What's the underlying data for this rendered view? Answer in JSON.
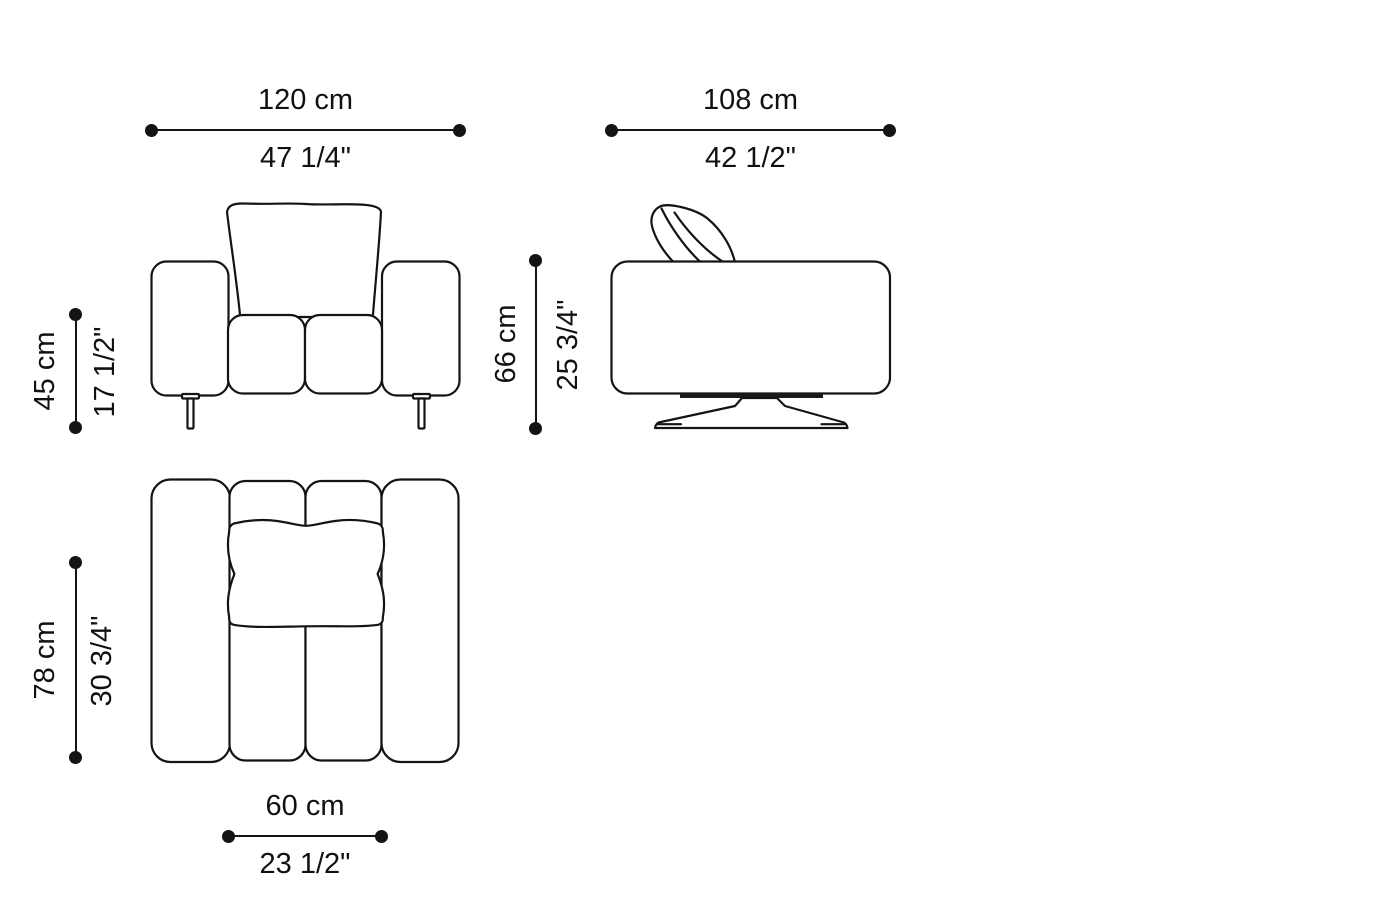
{
  "colors": {
    "background": "#ffffff",
    "line": "#141414",
    "text": "#111111"
  },
  "dims": {
    "front_width": {
      "cm": "120 cm",
      "inches": "47 1/4\""
    },
    "front_height": {
      "cm": "45 cm",
      "inches": "17 1/2\""
    },
    "side_width": {
      "cm": "108 cm",
      "inches": "42 1/2\""
    },
    "side_height": {
      "cm": "66 cm",
      "inches": "25 3/4\""
    },
    "plan_depth": {
      "cm": "78 cm",
      "inches": "30 3/4\""
    },
    "seat_width": {
      "cm": "60 cm",
      "inches": "23 1/2\""
    }
  }
}
